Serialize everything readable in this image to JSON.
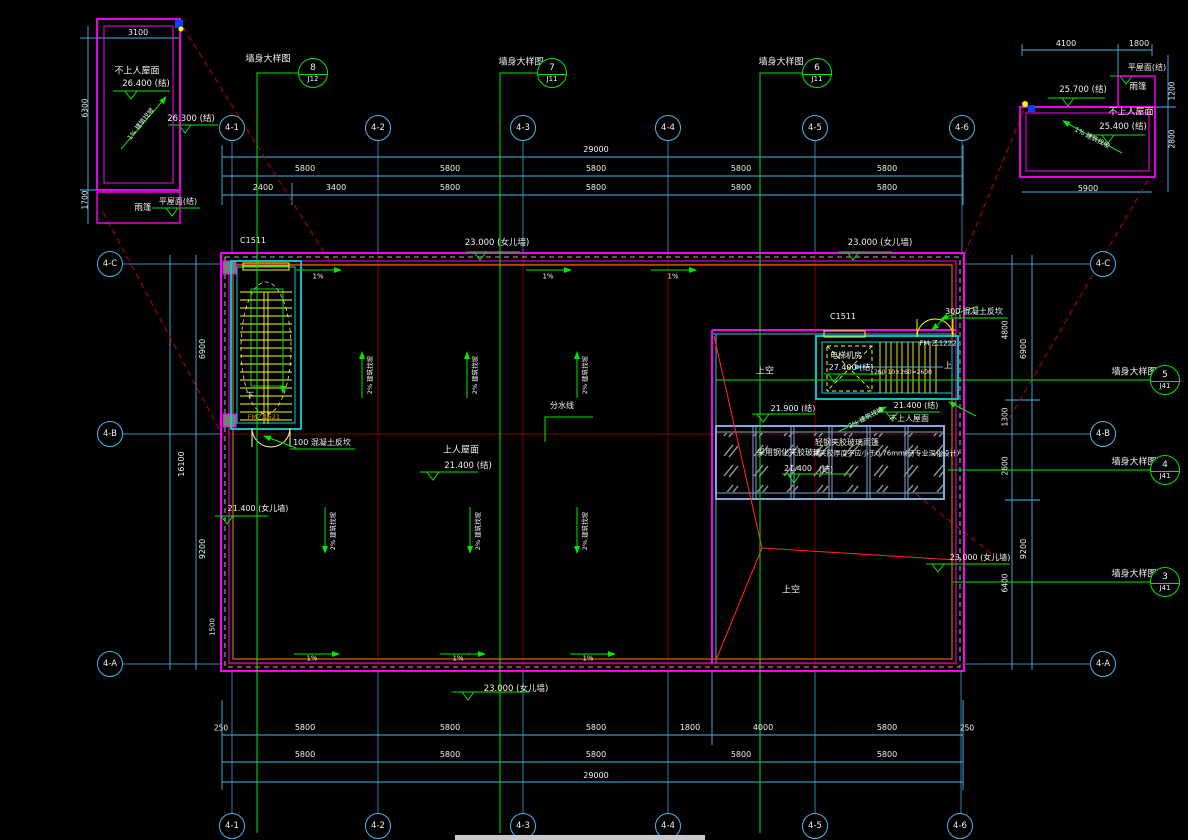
{
  "colors": {
    "background": "#000000",
    "dimension_lines": "#45b8f0",
    "walls": "#ff00ff",
    "stairs_windows": "#ffff00",
    "levels_sections": "#00e800",
    "grid_lines": "#a00000",
    "leaders": "#ff2222",
    "canopy_frame": "#7fa8dc",
    "text": "#f0f0f0",
    "orange": "#ff9100"
  },
  "annotations": [
    {
      "n": "dim-text",
      "t": "3100",
      "x": 138,
      "y": 33,
      "s": 8
    },
    {
      "n": "roof-label",
      "t": "不上人屋面",
      "x": 137,
      "y": 72,
      "s": 9
    },
    {
      "n": "level-text",
      "t": "26.400  (结)",
      "x": 146,
      "y": 84,
      "s": 8.5
    },
    {
      "n": "slope-label",
      "t": "1% 建筑找坡",
      "x": 141,
      "y": 124,
      "s": 6.5,
      "r": -52
    },
    {
      "n": "level-text",
      "t": "26.300  (结)",
      "x": 191,
      "y": 119,
      "s": 8.5
    },
    {
      "n": "roof-label",
      "t": "平屋面(结)",
      "x": 178,
      "y": 202,
      "s": 8
    },
    {
      "n": "canopy-label",
      "t": "雨篷",
      "x": 143,
      "y": 208,
      "s": 8.5
    },
    {
      "n": "dim-text",
      "t": "6300",
      "x": 85,
      "y": 108,
      "s": 7.5,
      "r": -90
    },
    {
      "n": "dim-text",
      "t": "1700",
      "x": 85,
      "y": 200,
      "s": 7.5,
      "r": -90
    },
    {
      "n": "dim-text",
      "t": "4100",
      "x": 1066,
      "y": 44,
      "s": 8
    },
    {
      "n": "dim-text",
      "t": "1800",
      "x": 1139,
      "y": 44,
      "s": 8
    },
    {
      "n": "roof-label",
      "t": "平屋面(结)",
      "x": 1147,
      "y": 68,
      "s": 8
    },
    {
      "n": "canopy-label",
      "t": "雨篷",
      "x": 1138,
      "y": 87,
      "s": 8.5
    },
    {
      "n": "level-text",
      "t": "25.700  (结)",
      "x": 1083,
      "y": 90,
      "s": 8.5
    },
    {
      "n": "roof-label",
      "t": "不上人屋面",
      "x": 1131,
      "y": 113,
      "s": 9
    },
    {
      "n": "level-text",
      "t": "25.400  (结)",
      "x": 1123,
      "y": 127,
      "s": 8.5
    },
    {
      "n": "slope-label",
      "t": "1% 建筑找坡",
      "x": 1092,
      "y": 138,
      "s": 6.5,
      "r": 27
    },
    {
      "n": "dim-text",
      "t": "1200",
      "x": 1172,
      "y": 91,
      "s": 7.5,
      "r": -90
    },
    {
      "n": "dim-text",
      "t": "2800",
      "x": 1172,
      "y": 139,
      "s": 7.5,
      "r": -90
    },
    {
      "n": "dim-text",
      "t": "5900",
      "x": 1088,
      "y": 189,
      "s": 8
    },
    {
      "n": "detail-label",
      "t": "墙身大样图",
      "x": 268,
      "y": 60,
      "s": 9
    },
    {
      "n": "detail-label",
      "t": "墙身大样图",
      "x": 521,
      "y": 63,
      "s": 9
    },
    {
      "n": "detail-label",
      "t": "墙身大样图",
      "x": 781,
      "y": 63,
      "s": 9
    },
    {
      "n": "dim-text",
      "t": "29000",
      "x": 596,
      "y": 150,
      "s": 8
    },
    {
      "n": "dim-text",
      "t": "5800",
      "x": 305,
      "y": 169,
      "s": 8
    },
    {
      "n": "dim-text",
      "t": "5800",
      "x": 450,
      "y": 169,
      "s": 8
    },
    {
      "n": "dim-text",
      "t": "5800",
      "x": 596,
      "y": 169,
      "s": 8
    },
    {
      "n": "dim-text",
      "t": "5800",
      "x": 741,
      "y": 169,
      "s": 8
    },
    {
      "n": "dim-text",
      "t": "5800",
      "x": 887,
      "y": 169,
      "s": 8
    },
    {
      "n": "dim-text",
      "t": "2400",
      "x": 263,
      "y": 188,
      "s": 8
    },
    {
      "n": "dim-text",
      "t": "3400",
      "x": 336,
      "y": 188,
      "s": 8
    },
    {
      "n": "dim-text",
      "t": "5800",
      "x": 450,
      "y": 188,
      "s": 8
    },
    {
      "n": "dim-text",
      "t": "5800",
      "x": 596,
      "y": 188,
      "s": 8
    },
    {
      "n": "dim-text",
      "t": "5800",
      "x": 741,
      "y": 188,
      "s": 8
    },
    {
      "n": "dim-text",
      "t": "5800",
      "x": 887,
      "y": 188,
      "s": 8
    },
    {
      "n": "window-tag",
      "t": "C1511",
      "x": 253,
      "y": 241,
      "s": 8
    },
    {
      "n": "level-text",
      "t": "23.000  (女儿墙)",
      "x": 497,
      "y": 243,
      "s": 8.5
    },
    {
      "n": "level-text",
      "t": "23.000  (女儿墙)",
      "x": 880,
      "y": 243,
      "s": 8.5
    },
    {
      "n": "slope-label",
      "t": "1%",
      "x": 318,
      "y": 277,
      "s": 7
    },
    {
      "n": "slope-label",
      "t": "1%",
      "x": 548,
      "y": 277,
      "s": 7
    },
    {
      "n": "slope-label",
      "t": "1%",
      "x": 673,
      "y": 277,
      "s": 7
    },
    {
      "n": "stair-label",
      "t": "下",
      "x": 250,
      "y": 396,
      "s": 8
    },
    {
      "n": "door-tag",
      "t": "FM乙1521",
      "x": 264,
      "y": 417,
      "s": 6.5,
      "c": "o"
    },
    {
      "n": "note",
      "t": "100  混凝土反坎",
      "x": 322,
      "y": 443,
      "s": 8
    },
    {
      "n": "roof-label",
      "t": "上人屋面",
      "x": 461,
      "y": 451,
      "s": 9
    },
    {
      "n": "level-text",
      "t": "21.400  (结)",
      "x": 468,
      "y": 466,
      "s": 8.5
    },
    {
      "n": "note",
      "t": "分水线",
      "x": 562,
      "y": 406,
      "s": 8
    },
    {
      "n": "level-text",
      "t": "21.400  (女儿墙)",
      "x": 258,
      "y": 509,
      "s": 8
    },
    {
      "n": "slope-label",
      "t": "2% 建筑找坡",
      "x": 370,
      "y": 375,
      "s": 6.5,
      "r": -90
    },
    {
      "n": "slope-label",
      "t": "2% 建筑找坡",
      "x": 475,
      "y": 375,
      "s": 6.5,
      "r": -90
    },
    {
      "n": "slope-label",
      "t": "2% 建筑找坡",
      "x": 585,
      "y": 375,
      "s": 6.5,
      "r": -90
    },
    {
      "n": "slope-label",
      "t": "2% 建筑找坡",
      "x": 333,
      "y": 531,
      "s": 6.5,
      "r": -90
    },
    {
      "n": "slope-label",
      "t": "2% 建筑找坡",
      "x": 478,
      "y": 531,
      "s": 6.5,
      "r": -90
    },
    {
      "n": "slope-label",
      "t": "2% 建筑找坡",
      "x": 585,
      "y": 531,
      "s": 6.5,
      "r": -90
    },
    {
      "n": "window-tag",
      "t": "C1511",
      "x": 843,
      "y": 317,
      "s": 8
    },
    {
      "n": "door-tag",
      "t": "FM 乙1222",
      "x": 938,
      "y": 344,
      "s": 7
    },
    {
      "n": "room-label",
      "t": "电梯机房",
      "x": 846,
      "y": 356,
      "s": 8
    },
    {
      "n": "level-text",
      "t": "27.400  (结)",
      "x": 851,
      "y": 368,
      "s": 8
    },
    {
      "n": "stair-label",
      "t": "上",
      "x": 948,
      "y": 366,
      "s": 8
    },
    {
      "n": "stair-dim",
      "t": "260 10×260=2600",
      "x": 903,
      "y": 373,
      "s": 6
    },
    {
      "n": "note",
      "t": "300  混凝土反坎",
      "x": 974,
      "y": 312,
      "s": 8
    },
    {
      "n": "level-text",
      "t": "21.900  (结)",
      "x": 793,
      "y": 409,
      "s": 8
    },
    {
      "n": "level-text",
      "t": "21.400  (结)",
      "x": 916,
      "y": 406,
      "s": 8
    },
    {
      "n": "roof-label",
      "t": "不上人屋面",
      "x": 909,
      "y": 419,
      "s": 8
    },
    {
      "n": "slope-label",
      "t": "2% 建筑找坡",
      "x": 866,
      "y": 418,
      "s": 6.5,
      "r": -28
    },
    {
      "n": "void-label",
      "t": "上空",
      "x": 765,
      "y": 372,
      "s": 9
    },
    {
      "n": "void-label",
      "t": "上空",
      "x": 791,
      "y": 591,
      "s": 9
    },
    {
      "n": "note",
      "t": "轻钢夹胶玻璃雨篷",
      "x": 847,
      "y": 443,
      "s": 8
    },
    {
      "n": "note",
      "t": "采用钢化夹胶玻璃",
      "x": 789,
      "y": 453,
      "s": 8
    },
    {
      "n": "note",
      "t": "共夹胶厚度不应小于0.76mm(待专业深化设计)",
      "x": 886,
      "y": 454,
      "s": 7
    },
    {
      "n": "level-text",
      "t": "21.400",
      "x": 798,
      "y": 469,
      "s": 8
    },
    {
      "n": "level-text",
      "t": "(结)",
      "x": 826,
      "y": 470,
      "s": 8
    },
    {
      "n": "detail-label",
      "t": "墙身大样图",
      "x": 1134,
      "y": 373,
      "s": 9
    },
    {
      "n": "detail-label",
      "t": "墙身大样图",
      "x": 1134,
      "y": 463,
      "s": 9
    },
    {
      "n": "detail-label",
      "t": "墙身大样图",
      "x": 1134,
      "y": 575,
      "s": 9
    },
    {
      "n": "level-text",
      "t": "23.000  (女儿墙)",
      "x": 980,
      "y": 558,
      "s": 8
    },
    {
      "n": "dim-text",
      "t": "6900",
      "x": 203,
      "y": 349,
      "s": 8,
      "r": -90
    },
    {
      "n": "dim-text",
      "t": "9200",
      "x": 203,
      "y": 549,
      "s": 8,
      "r": -90
    },
    {
      "n": "dim-text",
      "t": "16100",
      "x": 182,
      "y": 464,
      "s": 8,
      "r": -90
    },
    {
      "n": "dim-text",
      "t": "1500",
      "x": 213,
      "y": 627,
      "s": 7,
      "r": -90
    },
    {
      "n": "dim-text",
      "t": "4800",
      "x": 1005,
      "y": 330,
      "s": 7.5,
      "r": -90
    },
    {
      "n": "dim-text",
      "t": "1300",
      "x": 1005,
      "y": 417,
      "s": 7.5,
      "r": -90
    },
    {
      "n": "dim-text",
      "t": "2600",
      "x": 1005,
      "y": 466,
      "s": 7.5,
      "r": -90
    },
    {
      "n": "dim-text",
      "t": "6400",
      "x": 1005,
      "y": 583,
      "s": 7.5,
      "r": -90
    },
    {
      "n": "dim-text",
      "t": "6900",
      "x": 1024,
      "y": 349,
      "s": 8,
      "r": -90
    },
    {
      "n": "dim-text",
      "t": "9200",
      "x": 1024,
      "y": 549,
      "s": 8,
      "r": -90
    },
    {
      "n": "slope-label",
      "t": "1%",
      "x": 312,
      "y": 659,
      "s": 7
    },
    {
      "n": "slope-label",
      "t": "1%",
      "x": 458,
      "y": 659,
      "s": 7
    },
    {
      "n": "slope-label",
      "t": "1%",
      "x": 588,
      "y": 659,
      "s": 7
    },
    {
      "n": "level-text",
      "t": "23.000  (女儿墙)",
      "x": 516,
      "y": 689,
      "s": 8.5
    },
    {
      "n": "dim-text",
      "t": "250",
      "x": 221,
      "y": 728,
      "s": 7.5
    },
    {
      "n": "dim-text",
      "t": "5800",
      "x": 305,
      "y": 728,
      "s": 8
    },
    {
      "n": "dim-text",
      "t": "5800",
      "x": 450,
      "y": 728,
      "s": 8
    },
    {
      "n": "dim-text",
      "t": "5800",
      "x": 596,
      "y": 728,
      "s": 8
    },
    {
      "n": "dim-text",
      "t": "1800",
      "x": 690,
      "y": 728,
      "s": 8
    },
    {
      "n": "dim-text",
      "t": "4000",
      "x": 763,
      "y": 728,
      "s": 8
    },
    {
      "n": "dim-text",
      "t": "5800",
      "x": 887,
      "y": 728,
      "s": 8
    },
    {
      "n": "dim-text",
      "t": "250",
      "x": 967,
      "y": 728,
      "s": 7.5
    },
    {
      "n": "dim-text",
      "t": "5800",
      "x": 305,
      "y": 755,
      "s": 8
    },
    {
      "n": "dim-text",
      "t": "5800",
      "x": 450,
      "y": 755,
      "s": 8
    },
    {
      "n": "dim-text",
      "t": "5800",
      "x": 596,
      "y": 755,
      "s": 8
    },
    {
      "n": "dim-text",
      "t": "5800",
      "x": 741,
      "y": 755,
      "s": 8
    },
    {
      "n": "dim-text",
      "t": "5800",
      "x": 887,
      "y": 755,
      "s": 8
    },
    {
      "n": "dim-text",
      "t": "29000",
      "x": 596,
      "y": 776,
      "s": 8
    }
  ],
  "grid_bubbles": [
    {
      "label": "4-1",
      "x": 232,
      "y": 128
    },
    {
      "label": "4-2",
      "x": 378,
      "y": 128
    },
    {
      "label": "4-3",
      "x": 523,
      "y": 128
    },
    {
      "label": "4-4",
      "x": 668,
      "y": 128
    },
    {
      "label": "4-5",
      "x": 815,
      "y": 128
    },
    {
      "label": "4-6",
      "x": 962,
      "y": 128
    },
    {
      "label": "4-1",
      "x": 232,
      "y": 826
    },
    {
      "label": "4-2",
      "x": 378,
      "y": 826
    },
    {
      "label": "4-3",
      "x": 523,
      "y": 826
    },
    {
      "label": "4-4",
      "x": 668,
      "y": 826
    },
    {
      "label": "4-5",
      "x": 815,
      "y": 826
    },
    {
      "label": "4-6",
      "x": 960,
      "y": 826
    },
    {
      "label": "4-C",
      "x": 110,
      "y": 264
    },
    {
      "label": "4-B",
      "x": 110,
      "y": 434
    },
    {
      "label": "4-A",
      "x": 110,
      "y": 664
    },
    {
      "label": "4-C",
      "x": 1103,
      "y": 264
    },
    {
      "label": "4-B",
      "x": 1103,
      "y": 434
    },
    {
      "label": "4-A",
      "x": 1103,
      "y": 664
    }
  ],
  "detail_markers": [
    {
      "num": "8",
      "sheet": "J12",
      "x": 313,
      "y": 73
    },
    {
      "num": "7",
      "sheet": "J11",
      "x": 552,
      "y": 73
    },
    {
      "num": "6",
      "sheet": "J11",
      "x": 817,
      "y": 73
    },
    {
      "num": "5",
      "sheet": "J41",
      "x": 1165,
      "y": 380
    },
    {
      "num": "4",
      "sheet": "J41",
      "x": 1165,
      "y": 470
    },
    {
      "num": "3",
      "sheet": "J41",
      "x": 1165,
      "y": 582
    }
  ]
}
